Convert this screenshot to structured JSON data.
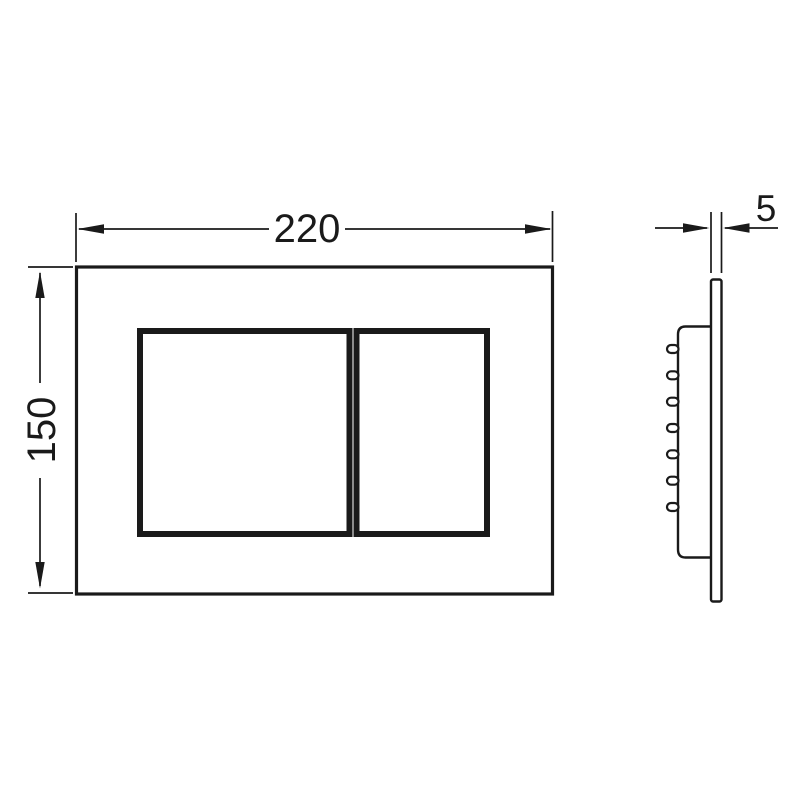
{
  "drawing": {
    "type": "technical-drawing",
    "subject": "dual-flush wc actuator plate with mounting bracket",
    "colors": {
      "line": "#1a1a1a",
      "background": "#ffffff"
    },
    "front_view": {
      "width_dimension_label": "220",
      "height_dimension_label": "150"
    },
    "side_view": {
      "thickness_dimension_label": "5"
    }
  }
}
